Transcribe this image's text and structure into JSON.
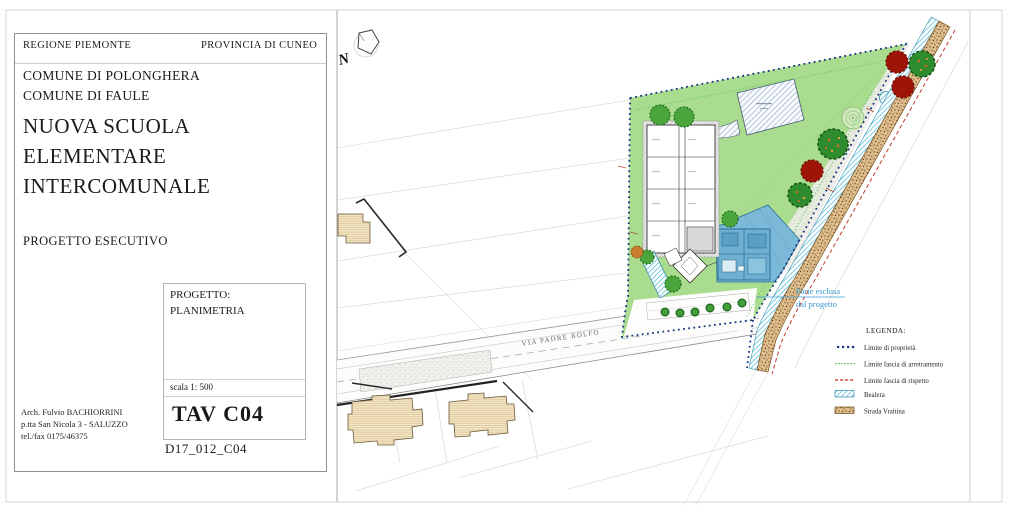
{
  "header": {
    "region": "REGIONE PIEMONTE",
    "province": "PROVINCIA DI CUNEO",
    "municipality_1": "COMUNE DI POLONGHERA",
    "municipality_2": "COMUNE DI FAULE",
    "project_title_line1": "NUOVA SCUOLA",
    "project_title_line2": "ELEMENTARE",
    "project_title_line3": "INTERCOMUNALE",
    "phase": "PROGETTO ESECUTIVO"
  },
  "title_block": {
    "project_label": "PROGETTO:",
    "drawing_name": "PLANIMETRIA",
    "scale": "scala 1: 500",
    "sheet_number": "TAV C04",
    "file_code": "D17_012_C04",
    "architect_line1": "Arch. Fulvio BACHIORRINI",
    "architect_line2": "p.tta San Nicola 3 - SALUZZO",
    "architect_line3": "tel./fax 0175/46375"
  },
  "plan": {
    "north_label": "N",
    "street_label": "VIA PADRE ROLFO",
    "excluded_note_line1": "Parte esclusa",
    "excluded_note_line2": "dal progetto"
  },
  "legend": {
    "title": "LEGENDA:",
    "items": [
      {
        "swatch": "blue-dotted-line",
        "label": "Limite di proprietà"
      },
      {
        "swatch": "green-dotted-line",
        "label": "Limite fascia di arretramento"
      },
      {
        "swatch": "red-dashed-line",
        "label": "Limite fascia di rispetto"
      },
      {
        "swatch": "cyan-hatch-band",
        "label": "Bealera"
      },
      {
        "swatch": "brown-stipple-band",
        "label": "Strada Vraitina"
      }
    ]
  },
  "colors": {
    "boundary_blue": "#16337f",
    "property_green": "#a9dc8f",
    "bealera_cyan": "#45b9d6",
    "road_brown": "#ddbe8f",
    "note_blue": "#3a9ad2",
    "tree_red": "#9e1508",
    "tree_green": "#2e8b2e"
  }
}
